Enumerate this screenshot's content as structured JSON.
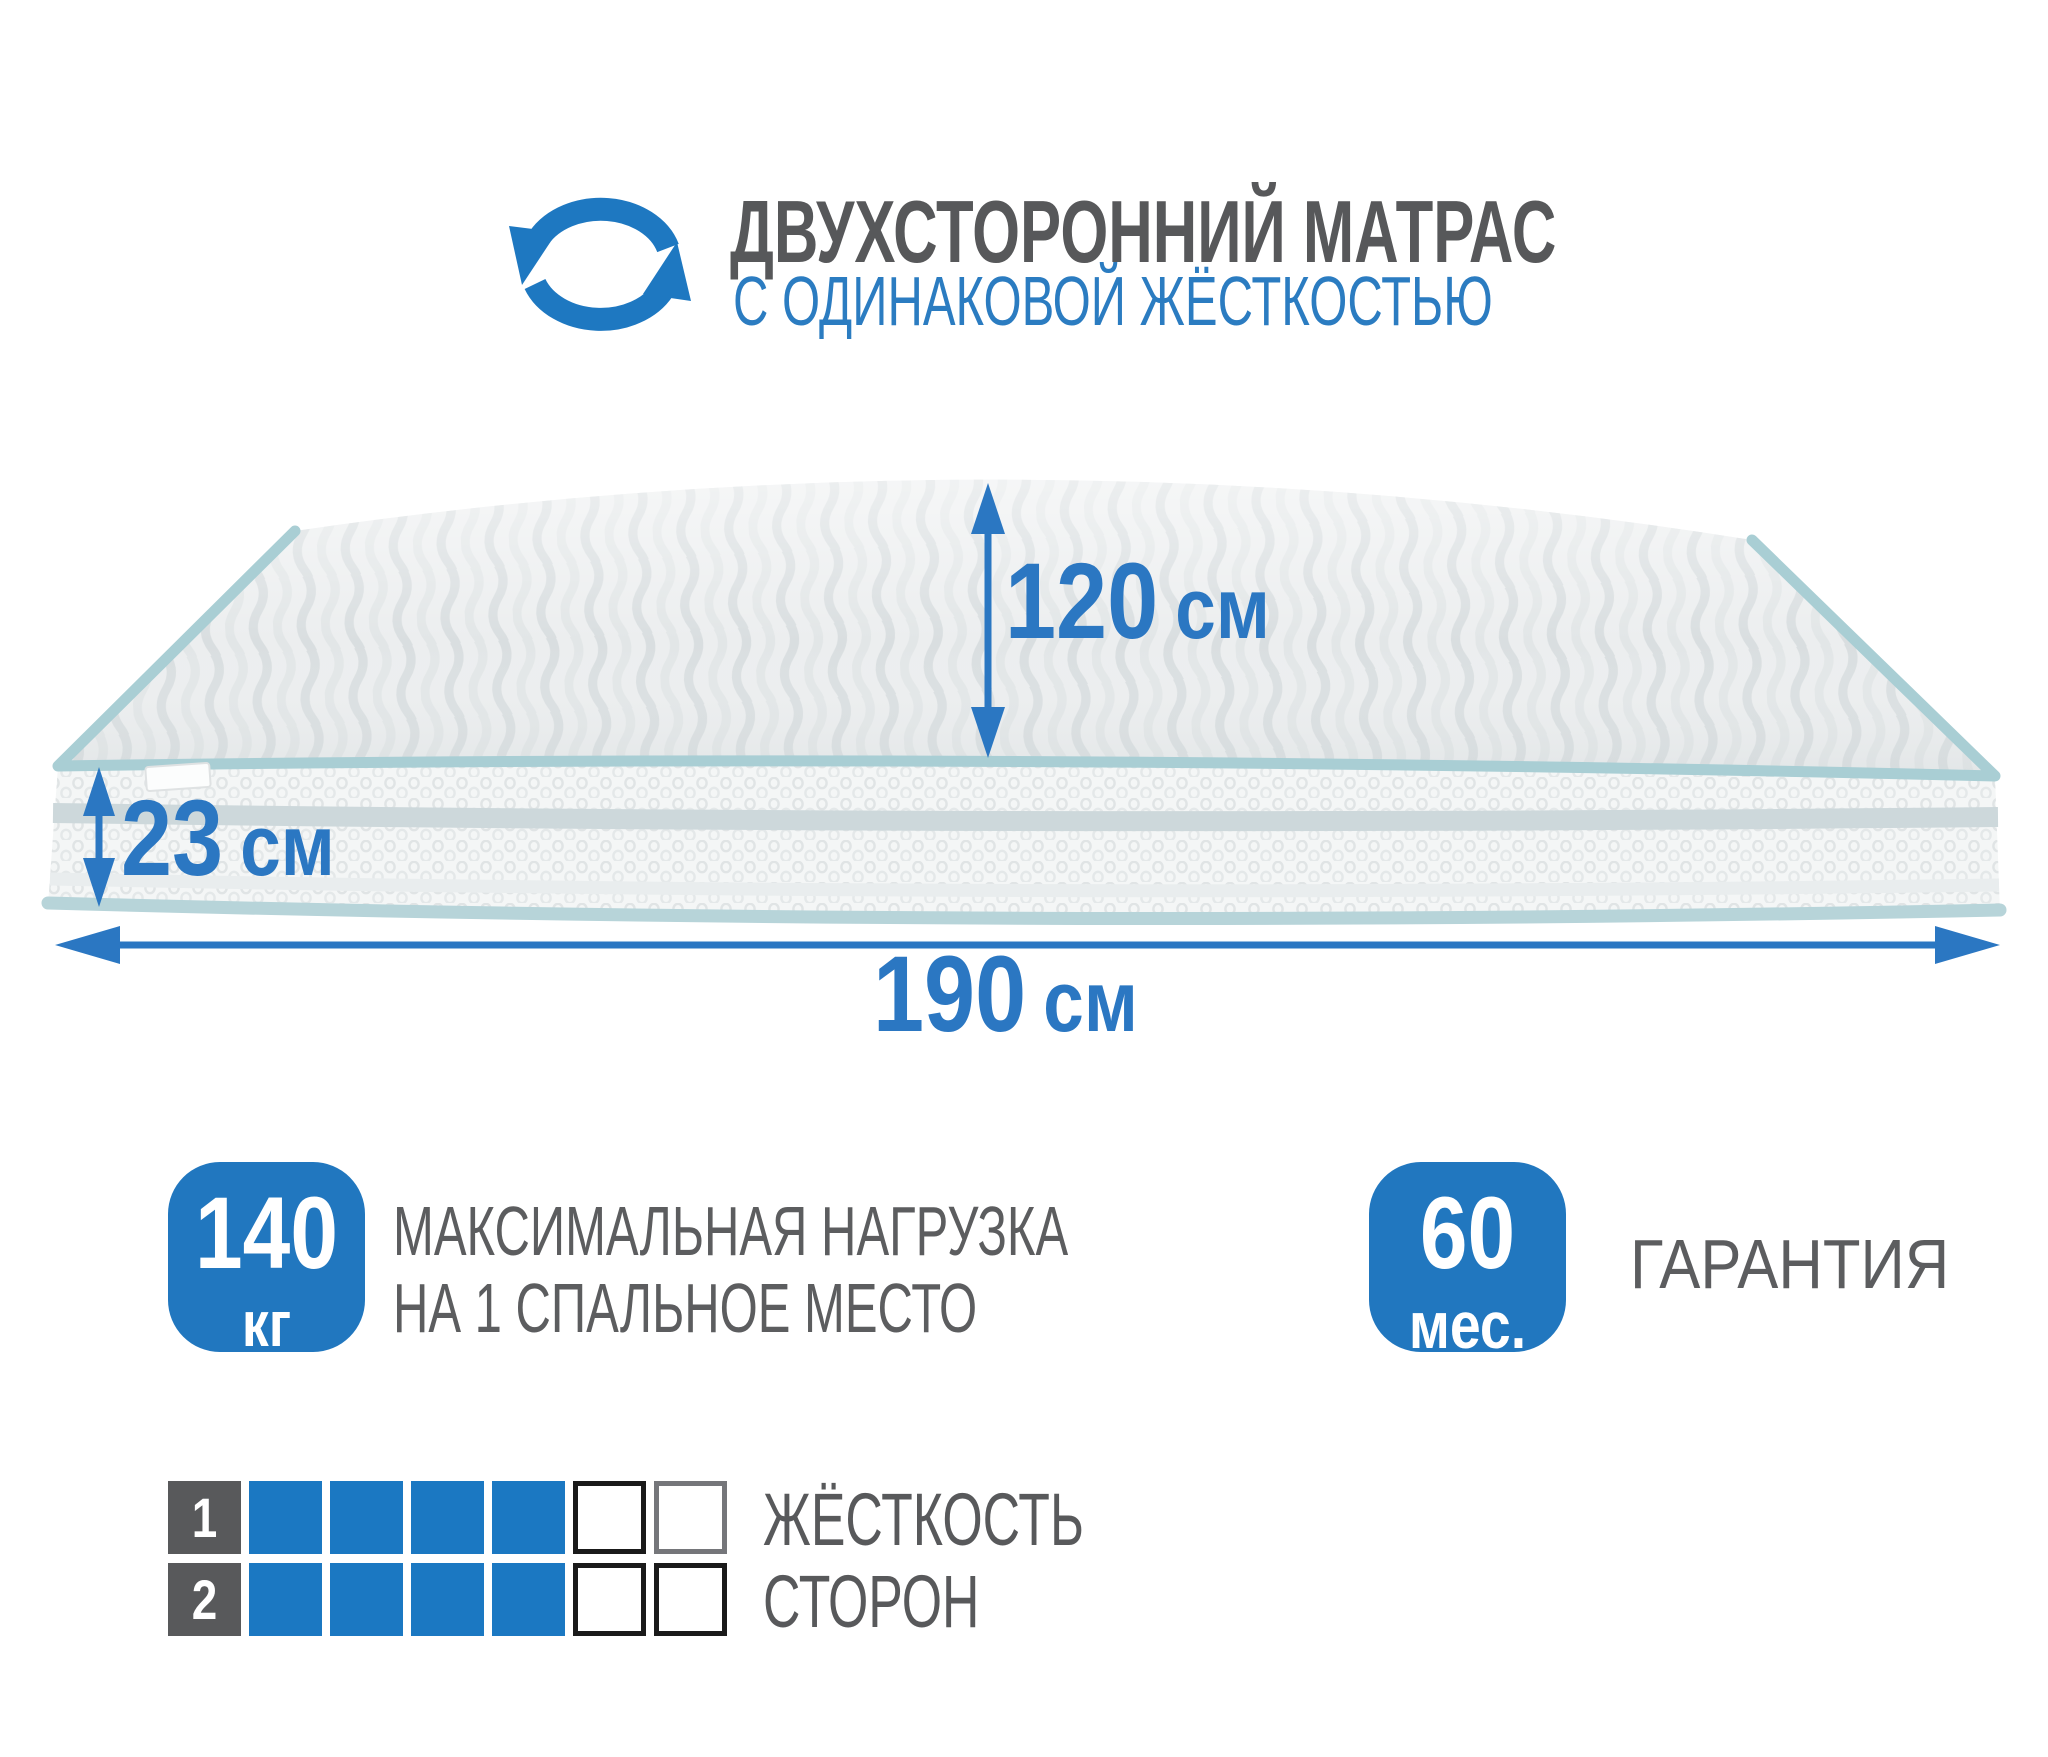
{
  "header": {
    "icon": "rotate-arrows-icon",
    "title": "ДВУХСТОРОННИЙ МАТРАС",
    "subtitle": "С ОДИНАКОВОЙ ЖЁСТКОСТЬЮ"
  },
  "mattress": {
    "illustration": "double-sided-mattress-3d-view",
    "dimensions": {
      "depth": {
        "value": "120",
        "unit": "см"
      },
      "height": {
        "value": "23",
        "unit": "см"
      },
      "length": {
        "value": "190",
        "unit": "см"
      }
    }
  },
  "features": {
    "max_load": {
      "value": "140",
      "unit": "кг",
      "label_line1": "МАКСИМАЛЬНАЯ НАГРУЗКА",
      "label_line2": "НА 1 СПАЛЬНОЕ МЕСТО"
    },
    "warranty": {
      "value": "60",
      "unit": "мес.",
      "label": "ГАРАНТИЯ"
    }
  },
  "firmness": {
    "label_line1": "ЖЁСТКОСТЬ",
    "label_line2": "СТОРОН",
    "scale_max": 6,
    "rows": [
      {
        "side": "1",
        "filled": 4,
        "empty_border_colors": [
          "#1a1a1a",
          "#75767a"
        ]
      },
      {
        "side": "2",
        "filled": 4,
        "empty_border_colors": [
          "#1a1a1a",
          "#1a1a1a"
        ]
      }
    ]
  },
  "colors": {
    "accent_blue": "#1e78c1",
    "text_blue": "#2b77c2",
    "title_gray": "#57585a",
    "text_gray": "#5c5d5f",
    "piping_teal": "#a9ced4",
    "side_band": "#cdd8db",
    "fabric_light": "#eceeef"
  }
}
